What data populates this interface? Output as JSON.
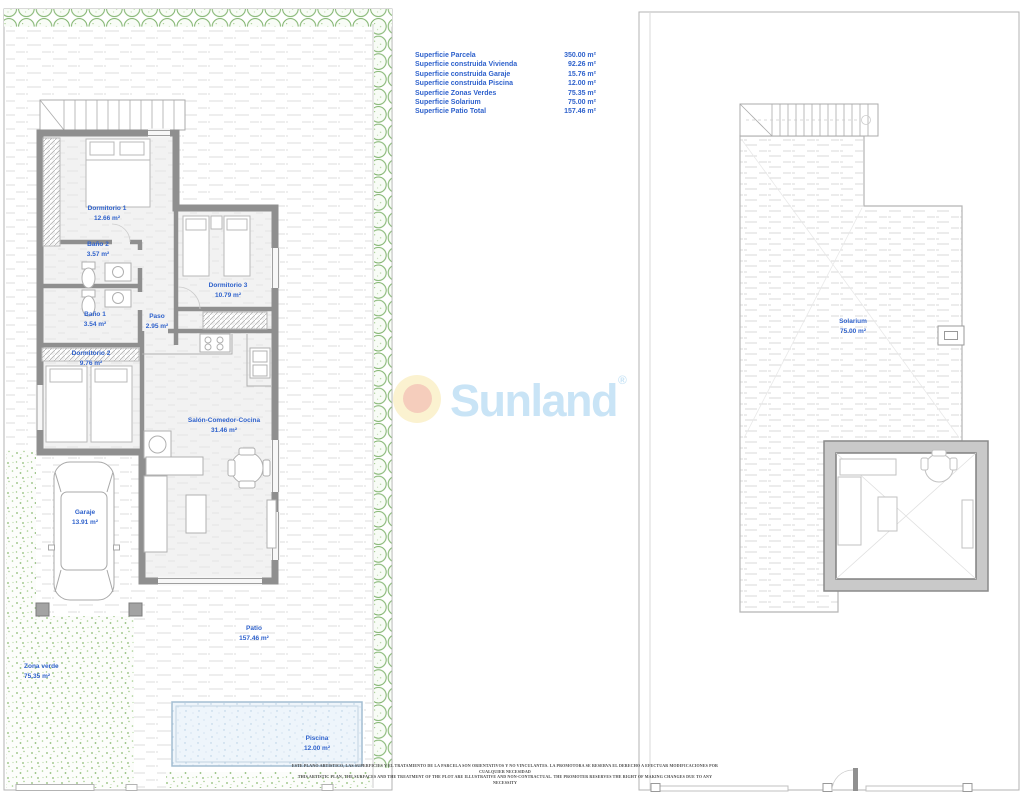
{
  "surface_table": {
    "rows": [
      {
        "label": "Superficie Parcela",
        "value": "350.00 m²"
      },
      {
        "label": "Superficie construida Vivienda",
        "value": "92.26 m²"
      },
      {
        "label": "Superficie construida Garaje",
        "value": "15.76 m²"
      },
      {
        "label": "Superficie construida Piscina",
        "value": "12.00 m²"
      },
      {
        "label": "Superficie Zonas Verdes",
        "value": "75.35 m²"
      },
      {
        "label": "Superficie Solarium",
        "value": "75.00 m²"
      },
      {
        "label": "Superficie Patio Total",
        "value": "157.46 m²"
      }
    ]
  },
  "logo": {
    "text": "Sunland",
    "registered": "®"
  },
  "rooms": {
    "dormitorio1": {
      "name": "Dormitorio 1",
      "area": "12.66 m²"
    },
    "bano2": {
      "name": "Baño 2",
      "area": "3.57 m²"
    },
    "dormitorio3": {
      "name": "Dormitorio 3",
      "area": "10.79 m²"
    },
    "bano1": {
      "name": "Baño 1",
      "area": "3.54 m²"
    },
    "paso": {
      "name": "Paso",
      "area": "2.95 m²"
    },
    "dormitorio2": {
      "name": "Dormitorio 2",
      "area": "9.76 m²"
    },
    "salon": {
      "name": "Salón-Comedor-Cocina",
      "area": "31.46 m²"
    },
    "garaje": {
      "name": "Garaje",
      "area": "13.91 m²"
    },
    "patio": {
      "name": "Patio",
      "area": "157.46 m²"
    },
    "zona_verde": {
      "name": "Zona verde",
      "area": "75.35 m²"
    },
    "piscina": {
      "name": "Piscina",
      "area": "12.00 m²"
    },
    "solarium": {
      "name": "Solarium",
      "area": "75.00 m²"
    }
  },
  "disclaimer": {
    "line1": "ESTE PLANO ARTISTICO, LAS SUPERFICIES Y EL TRATAMIENTO DE LA PARCELA SON ORIENTATIVOS Y NO VINCULANTES. LA PROMOTORA SE RESERVA EL DERECHO A EFECTUAR MODIFICACIONES POR CUALQUIER NECESIDAD",
    "line2": "THIS ARTISTIC PLAN, THE SURFACES AND THE TREATMENT OF THE PLOT ARE ILLUSTRATIVE AND NON-CONTRACTUAL. THE PROMOTER RESERVES THE RIGHT OF MAKING CHANGES DUE TO ANY NECESSITY"
  },
  "colors": {
    "label_blue": "#2f62cc",
    "wall_gray": "#8f8f8f",
    "hedge_green": "#7cb169",
    "grass_green": "#8abb71",
    "pool_blue": "#eef5fb",
    "logo_blue": "#c9e4f6",
    "logo_sun_outer": "#fbf2d0",
    "logo_sun_inner": "#f5cdbc"
  }
}
